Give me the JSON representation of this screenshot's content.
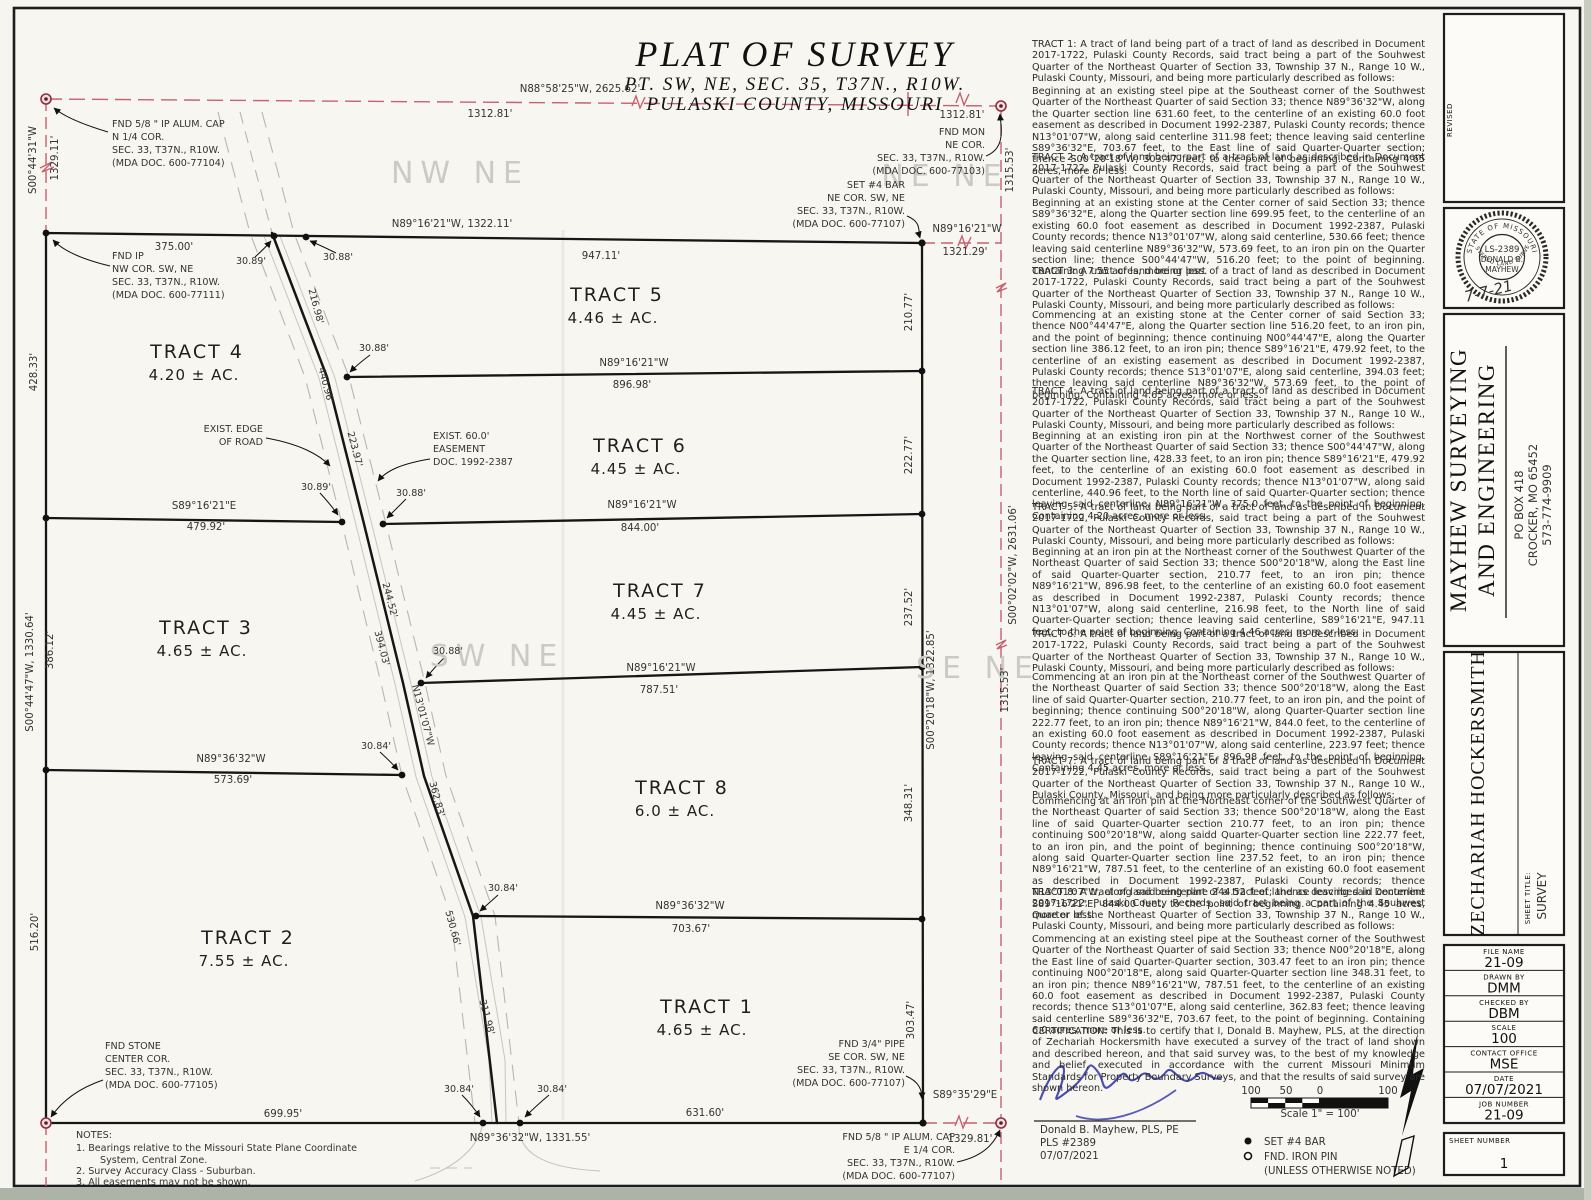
{
  "title": {
    "main": "PLAT OF SURVEY",
    "sub1": "PT. SW, NE, SEC. 35, T37N., R10W.",
    "sub2": "PULASKI COUNTY, MISSOURI"
  },
  "plan": {
    "top_bearing": "N88°58'25\"W, 2625.62'",
    "top_dist_l": "1312.81'",
    "top_dist_r": "1312.81'",
    "w_sec_bearing": "S00°44'31\"W",
    "w_sec_dist": "1329.11'",
    "n_bearing": "N89°16'21\"W, 1322.11'",
    "n_947": "947.11'",
    "n_375": "375.00'",
    "t3089": "30.89'",
    "t3088": "30.88'",
    "stub_bearing": "N89°16'21\"W",
    "stub_dist": "1321.29'",
    "e1315a": "1315.53'",
    "e1315b": "1315.53'",
    "e_sec_bearing": "S00°02'02\"W, 2631.06'",
    "w42833": "428.33'",
    "w_bearing": "S00°44'47\"W, 1330.64'",
    "w38612": "386.12'",
    "w51620": "516.20'",
    "e21077": "210.77'",
    "e22277": "222.77'",
    "e23752": "237.52'",
    "e_bearing": "S00°20'18\"W, 1322.85'",
    "e34831": "348.31'",
    "e30347": "303.47'",
    "l1_bearing": "N89°16'21\"W",
    "l1_dist": "896.98'",
    "l2w_bearing": "S89°16'21\"E",
    "l2w_dist": "479.92'",
    "l2e_bearing": "N89°16'21\"W",
    "l2e_dist": "844.00'",
    "l3_bearing": "N89°16'21\"W",
    "l3_dist": "787.51'",
    "l4_bearing": "N89°36'32\"W",
    "l4_dist": "573.69'",
    "l5_bearing": "N89°36'32\"W",
    "l5_dist": "703.67'",
    "s69995": "699.95'",
    "s_bearing": "N89°36'32\"W, 1331.55'",
    "s63160": "631.60'",
    "ssec_bearing": "S89°35'29\"E",
    "ssec_dist": "1329.81'",
    "r21698": "216.98'",
    "r44096": "440.96'",
    "r22397": "223.97'",
    "r24452": "244.52'",
    "r39403": "394.03'",
    "r_bearing": "N13'01'07\"W",
    "r36283": "362.83'",
    "r53066": "530.66'",
    "r31198": "311.98'",
    "c3088_1": "30.88'",
    "c3089_2": "30.89'",
    "c3088_2": "30.88'",
    "c3088_3": "30.88'",
    "c3084_4": "30.84'",
    "c3084_5": "30.84'",
    "c3084_s1": "30.84'",
    "c3084_s2": "30.84'",
    "edge1": "EXIST. EDGE",
    "edge2": "OF ROAD",
    "ease1": "EXIST. 60.0'",
    "ease2": "EASEMENT",
    "ease3": "DOC. 1992-2387",
    "qtr_nw": "NW NE",
    "qtr_ne": "NE NE",
    "qtr_sw": "SW NE",
    "qtr_se": "SE NE",
    "mon_n14": [
      "FND 5/8 \" IP ALUM. CAP",
      "N 1/4 COR.",
      "SEC. 33, T37N., R10W.",
      "(MDA DOC. 600-77104)"
    ],
    "mon_nw": [
      "FND IP",
      "NW COR. SW, NE",
      "SEC. 33, T37N., R10W.",
      "(MDA DOC. 600-77111)"
    ],
    "mon_ne": [
      "FND MON",
      "NE COR.",
      "SEC. 33, T37N., R10W.",
      "(MDA DOC. 600-77103)"
    ],
    "mon_set": [
      "SET #4 BAR",
      "NE COR. SW, NE",
      "SEC. 33, T37N., R10W.",
      "(MDA DOC. 600-77107)"
    ],
    "mon_stone": [
      "FND STONE",
      "CENTER COR.",
      "SEC. 33, T37N., R10W.",
      "(MDA DOC. 600-77105)"
    ],
    "mon_pipe": [
      "FND 3/4\" PIPE",
      "SE COR. SW, NE",
      "SEC. 33, T37N., R10W.",
      "(MDA DOC. 600-77107)"
    ],
    "mon_e14": [
      "FND 5/8 \" IP ALUM. CAP",
      "E 1/4 COR.",
      "SEC. 33, T37N., R10W.",
      "(MDA DOC. 600-77107)"
    ],
    "tracts": {
      "t1": {
        "name": "TRACT 1",
        "area": "4.65 ± AC."
      },
      "t2": {
        "name": "TRACT 2",
        "area": "7.55 ± AC."
      },
      "t3": {
        "name": "TRACT 3",
        "area": "4.65 ± AC."
      },
      "t4": {
        "name": "TRACT 4",
        "area": "4.20 ± AC."
      },
      "t5": {
        "name": "TRACT 5",
        "area": "4.46 ± AC."
      },
      "t6": {
        "name": "TRACT 6",
        "area": "4.45 ± AC."
      },
      "t7": {
        "name": "TRACT 7",
        "area": "4.45 ± AC."
      },
      "t8": {
        "name": "TRACT 8",
        "area": "6.0 ± AC."
      }
    },
    "notes": [
      "NOTES:",
      "1.   Bearings relative to the Missouri State Plane Coordinate",
      "System, Central Zone.",
      "2.   Survey Accuracy Class - Suburban.",
      "3.   All easements may not be shown."
    ]
  },
  "descriptions": [
    "TRACT 1:  A tract of land being part of a tract of land as described in Document 2017-1722, Pulaski County Records, said tract being a part of the Souhwest Quarter of the Northeast Quarter of Section 33, Township 37 N., Range 10 W., Pulaski County, Missouri, and being more particularly described as follows:",
    "Beginning at an existing steel pipe at the Southeast corner of the Southwest Quarter of the Northeast Quarter of said Section 33; thence N89°36'32\"W, along the Quarter section line 631.60 feet, to the centerline of an existing 60.0 foot easement as described in Document 1992-2387, Pulaski County records; thence N13°01'07\"W, along said centerline 311.98 feet; thence leaving said centerline S89°36'32\"E, 703.67 feet, to the East line of said Quarter-Quarter section; thence S00°20'18\"W, 303.47 feet; to the point of beginning. Containing 4.65 acres, more or less.",
    "TRACT 2:  A tract of land being part of a tract of land as described in Document 2017-1722, Pulaski County Records, said tract being a part of the Souhwest Quarter of the Northeast Quarter of Section 33, Township 37 N., Range 10 W., Pulaski County, Missouri, and being more particularly described as follows:",
    "Beginning at an existing stone at the Center corner of said Section 33; thence S89°36'32\"E, along the Quarter section line 699.95 feet, to the centerline of an existing 60.0 foot easement as described in Document 1992-2387, Pulaski County records; thence N13°01'07\"W, along said centerline, 530.66 feet; thence leaving said centerline N89°36'32\"W, 573.69 feet, to an iron pin on the Quarter section line; thence S00°44'47\"W, 516.20 feet; to the point of beginning. Containing 7.55 acres, more or less.",
    "TRACT 3:  A tract of land being part of a tract of land as described in Document 2017-1722, Pulaski County Records, said tract being a part of the Souhwest Quarter of the Northeast Quarter of Section 33, Township 37 N., Range 10 W., Pulaski County, Missouri, and being more particularly described as follows:",
    "Commencing at an existing stone at the Center corner of said Section 33; thence N00°44'47\"E, along the Quarter section line 516.20 feet, to an iron pin, and the point of beginning; thence continuing N00°44'47\"E, along the Quarter section line 386.12 feet, to an iron pin; thence S89°16'21\"E, 479.92 feet, to the centerline of an existing easement as described in Document 1992-2387, Pulaski County records; thence S13°01'07\"E, along said centerline, 394.03 feet; thence leaving said centerline N89°36'32\"W, 573.69 feet, to the point of beginning. Containing 4.65 acres, more or less.",
    "TRACT 4:  A tract of land being part of a tract of land as described in Document 2017-1722, Pulaski County Records, said tract being a part of the Souhwest Quarter of the Northeast Quarter of Section 33, Township 37 N., Range 10 W., Pulaski County, Missouri, and being more particularly described as follows:",
    "Beginning at an existing iron pin at the Northwest corner of the Southwest Quarter of the Northeast Quarter of said Section 33; thence S00°44'47\"W, along the Quarter section line, 428.33 feet, to an iron pin; thence S89°16'21\"E, 479.92 feet, to the centerline of an existing 60.0 foot easement as described in Document 1992-2387, Pulaski County records; thence N13°01'07\"W, along said centerline, 440.96 feet, to the North line of said Quarter-Quarter section; thence leaving said centerline, N89°16'21\"W, 375.0 feet, to the point of beginning. Containing 4.20 acres, more or less.",
    "TRACT 5:  A tract of land being part of a tract of land as described in Document 2017-1722, Pulaski County Records, said tract being a part of the Souhwest Quarter of the Northeast Quarter of Section 33, Township 37 N., Range 10 W., Pulaski County, Missouri, and being more particularly described as follows:",
    "Beginning at an iron pin at the Northeast corner of the Southwest Quarter of the Northeast Quarter of said Section 33; thence S00°20'18\"W, along the East line of said Quarter-Quarter section, 210.77 feet, to an iron pin; thence N89°16'21\"W, 896.98 feet, to the centerline of an existing 60.0 foot easement as described in Document 1992-2387, Pulaski County records; thence N13°01'07\"W, along said centerline, 216.98 feet, to the North line of said Quarter-Quarter section; thence leaving said centerline, S89°16'21\"E, 947.11 feet, to the point of beginning. Containing 4.46 acres, more or less.",
    "TRACT 6:  A tract of land being part of a tract of land as described in Document 2017-1722, Pulaski County Records, said tract being a part of the Souhwest Quarter of the Northeast Quarter of Section 33, Township 37 N., Range 10 W., Pulaski County, Missouri, and being more particularly described as follows:",
    "Commencing at an iron pin at the Northeast corner of the Southwest Quarter of the Northeast Quarter of said Section 33; thence S00°20'18\"W, along the East line of said Quarter-Quarter section, 210.77 feet, to an iron pin, and the point of beginning; thence continuing S00°20'18\"W, along Quarter-Quarter section line 222.77 feet, to an iron pin; thence N89°16'21\"W, 844.0 feet, to the centerline of an existing 60.0 foot easement as described in Document 1992-2387, Pulaski County records; thence N13°01'07\"W, along said centerline, 223.97 feet; thence leaving said centerline S89°16'21\"E, 896.98 feet, to the point of beginning. Containing 4.45 acres, more or less.",
    "TRACT 7:  A tract of land being part of a tract of land as described in Document 2017-1722, Pulaski County Records, said tract being a part of the Souhwest Quarter of the Northeast Quarter of Section 33, Township 37 N., Range 10 W., Pulaski County, Missouri, and being more particularly described as follows:",
    "Commencing at an iron pin at the Northeast corner of the Southwest Quarter of the Northeast Quarter of said Section 33; thence S00°20'18\"W, along the East line of said Quarter-Quarter section 210.77 feet, to an iron pin; thence continuing S00°20'18\"W, along saidd Quarter-Quarter section line 222.77 feet, to an iron pin, and the point of beginning; thence continuing S00°20'18\"W, along said Quarter-Quarter section line 237.52 feet, to an iron pin; thence N89°16'21\"W, 787.51 feet, to the centerline of an existing 60.0 foot easement as described in Document 1992-2387, Pulaski County records; thence N13°01'07\"W, along said centerline 244.52 feet; thence leaving said centerline S89°16'21\"E, 844.00 feet, to the point of beginning. Containing 4.45 acres, more or less.",
    "TRACT 8:  A tract of land being part of a tract of land as described in Document 2017-1722, Pulaski County Records, said tract being a part of the Souhwest Quarter of the Northeast Quarter of Section 33, Township 37 N., Range 10 W., Pulaski County, Missouri, and being more particularly described as follows:",
    "Commencing at an existing steel pipe at the Southeast corner of the Southwest Quarter of the Northeast Quarter of said Section 33; thence N00°20'18\"E, along the East line of said Quarter-Quarter section, 303.47 feet to an iron pin; thence continuing N00°20'18\"E, along said Quarter-Quarter section line 348.31 feet, to an iron pin; thence N89°16'21\"W, 787.51 feet, to the centerline of an existing 60.0 foot easement as described in Document 1992-2387, Pulaski County records; thence S13°01'07\"E, along said centerline, 362.83 feet; thence leaving said centerline S89°36'32\"E, 703.67 feet, to the point of beginning. Containing 6.0 acres, more or less."
  ],
  "certification": "CERTIFICATION:  This is to certify that I, Donald B. Mayhew, PLS, at the direction of Zechariah Hockersmith have executed a survey of the tract of land shown and described hereon, and that said survey was, to the best of my knowledge and belief, executed in accordance with the current Missouri Minimum Standards for Property Boundary Surveys, and that the results of said survey are shown hereon.",
  "signature": {
    "name": "Donald B. Mayhew, PLS, PE",
    "pls": "PLS #2389",
    "date": "07/07/2021"
  },
  "scalebar": {
    "t100a": "100",
    "t50": "50",
    "t0": "0",
    "t100b": "100",
    "caption": "Scale 1\" = 100'"
  },
  "legend": {
    "set": "SET #4 BAR",
    "fnd": "FND. IRON PIN",
    "note": "(UNLESS OTHERWISE NOTED)"
  },
  "titleblock": {
    "revised": "REVISED",
    "seal": {
      "arc_top": "STATE OF MISSOURI",
      "arc_bottom": "REGISTERED LAND SURVEYOR",
      "line1": "LS-2389",
      "line2": "DONALD B.",
      "line3": "MAYHEW",
      "handwritten": "7-7-21"
    },
    "company": {
      "name1": "MAYHEW SURVEYING",
      "name2": "AND ENGINEERING",
      "addr1": "PO BOX 418",
      "addr2": "CROCKER, MO 65452",
      "addr3": "573-774-9909"
    },
    "client": "ZECHARIAH HOCKERSMITH",
    "sheet_title_label": "SHEET TITLE:",
    "sheet_title": "SURVEY",
    "rows": [
      {
        "label": "FILE NAME",
        "value": "21-09"
      },
      {
        "label": "DRAWN BY",
        "value": "DMM"
      },
      {
        "label": "CHECKED BY",
        "value": "DBM"
      },
      {
        "label": "SCALE",
        "value": "100"
      },
      {
        "label": "CONTACT OFFICE",
        "value": "MSE"
      },
      {
        "label": "DATE",
        "value": "07/07/2021"
      },
      {
        "label": "JOB NUMBER",
        "value": "21-09"
      }
    ],
    "sheet_number_label": "SHEET NUMBER",
    "sheet_number": "1"
  },
  "colors": {
    "section_red": "#c8606f",
    "ink": "#1b1b1b",
    "ghost_gray": "#cbcbc6",
    "signature_blue": "#3b3fae"
  }
}
